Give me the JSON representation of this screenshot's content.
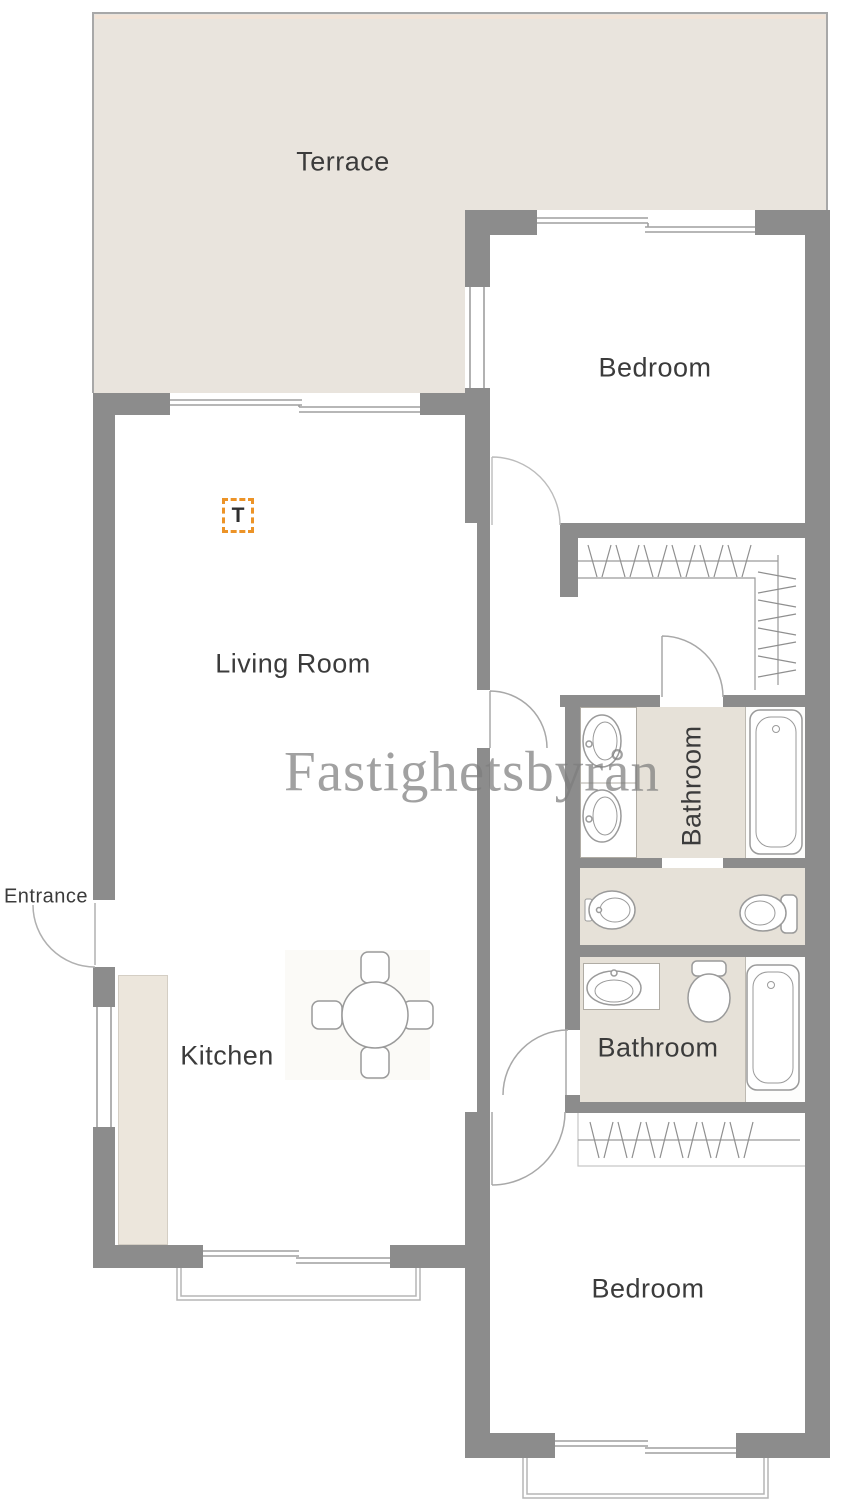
{
  "plan_title": "Apartment floor plan",
  "watermark": "Fastighetsbyrån",
  "labels": {
    "terrace": "Terrace",
    "bedroom_top": "Bedroom",
    "bedroom_bottom": "Bedroom",
    "living_room": "Living Room",
    "kitchen": "Kitchen",
    "bathroom_top": "Bathroom",
    "bathroom_bottom": "Bathroom",
    "entrance": "Entrance",
    "tv_marker": "T"
  },
  "colors": {
    "wall": "#8c8c8c",
    "terrace_floor": "#e9e4dd",
    "bathroom_floor": "#e6e1d8",
    "kitchen_counter": "#ece6dc",
    "line": "#9f9f9f",
    "accent_orange": "#ec9327",
    "label_text": "#3b3b3b",
    "watermark_gray": "#7e7e7e"
  }
}
